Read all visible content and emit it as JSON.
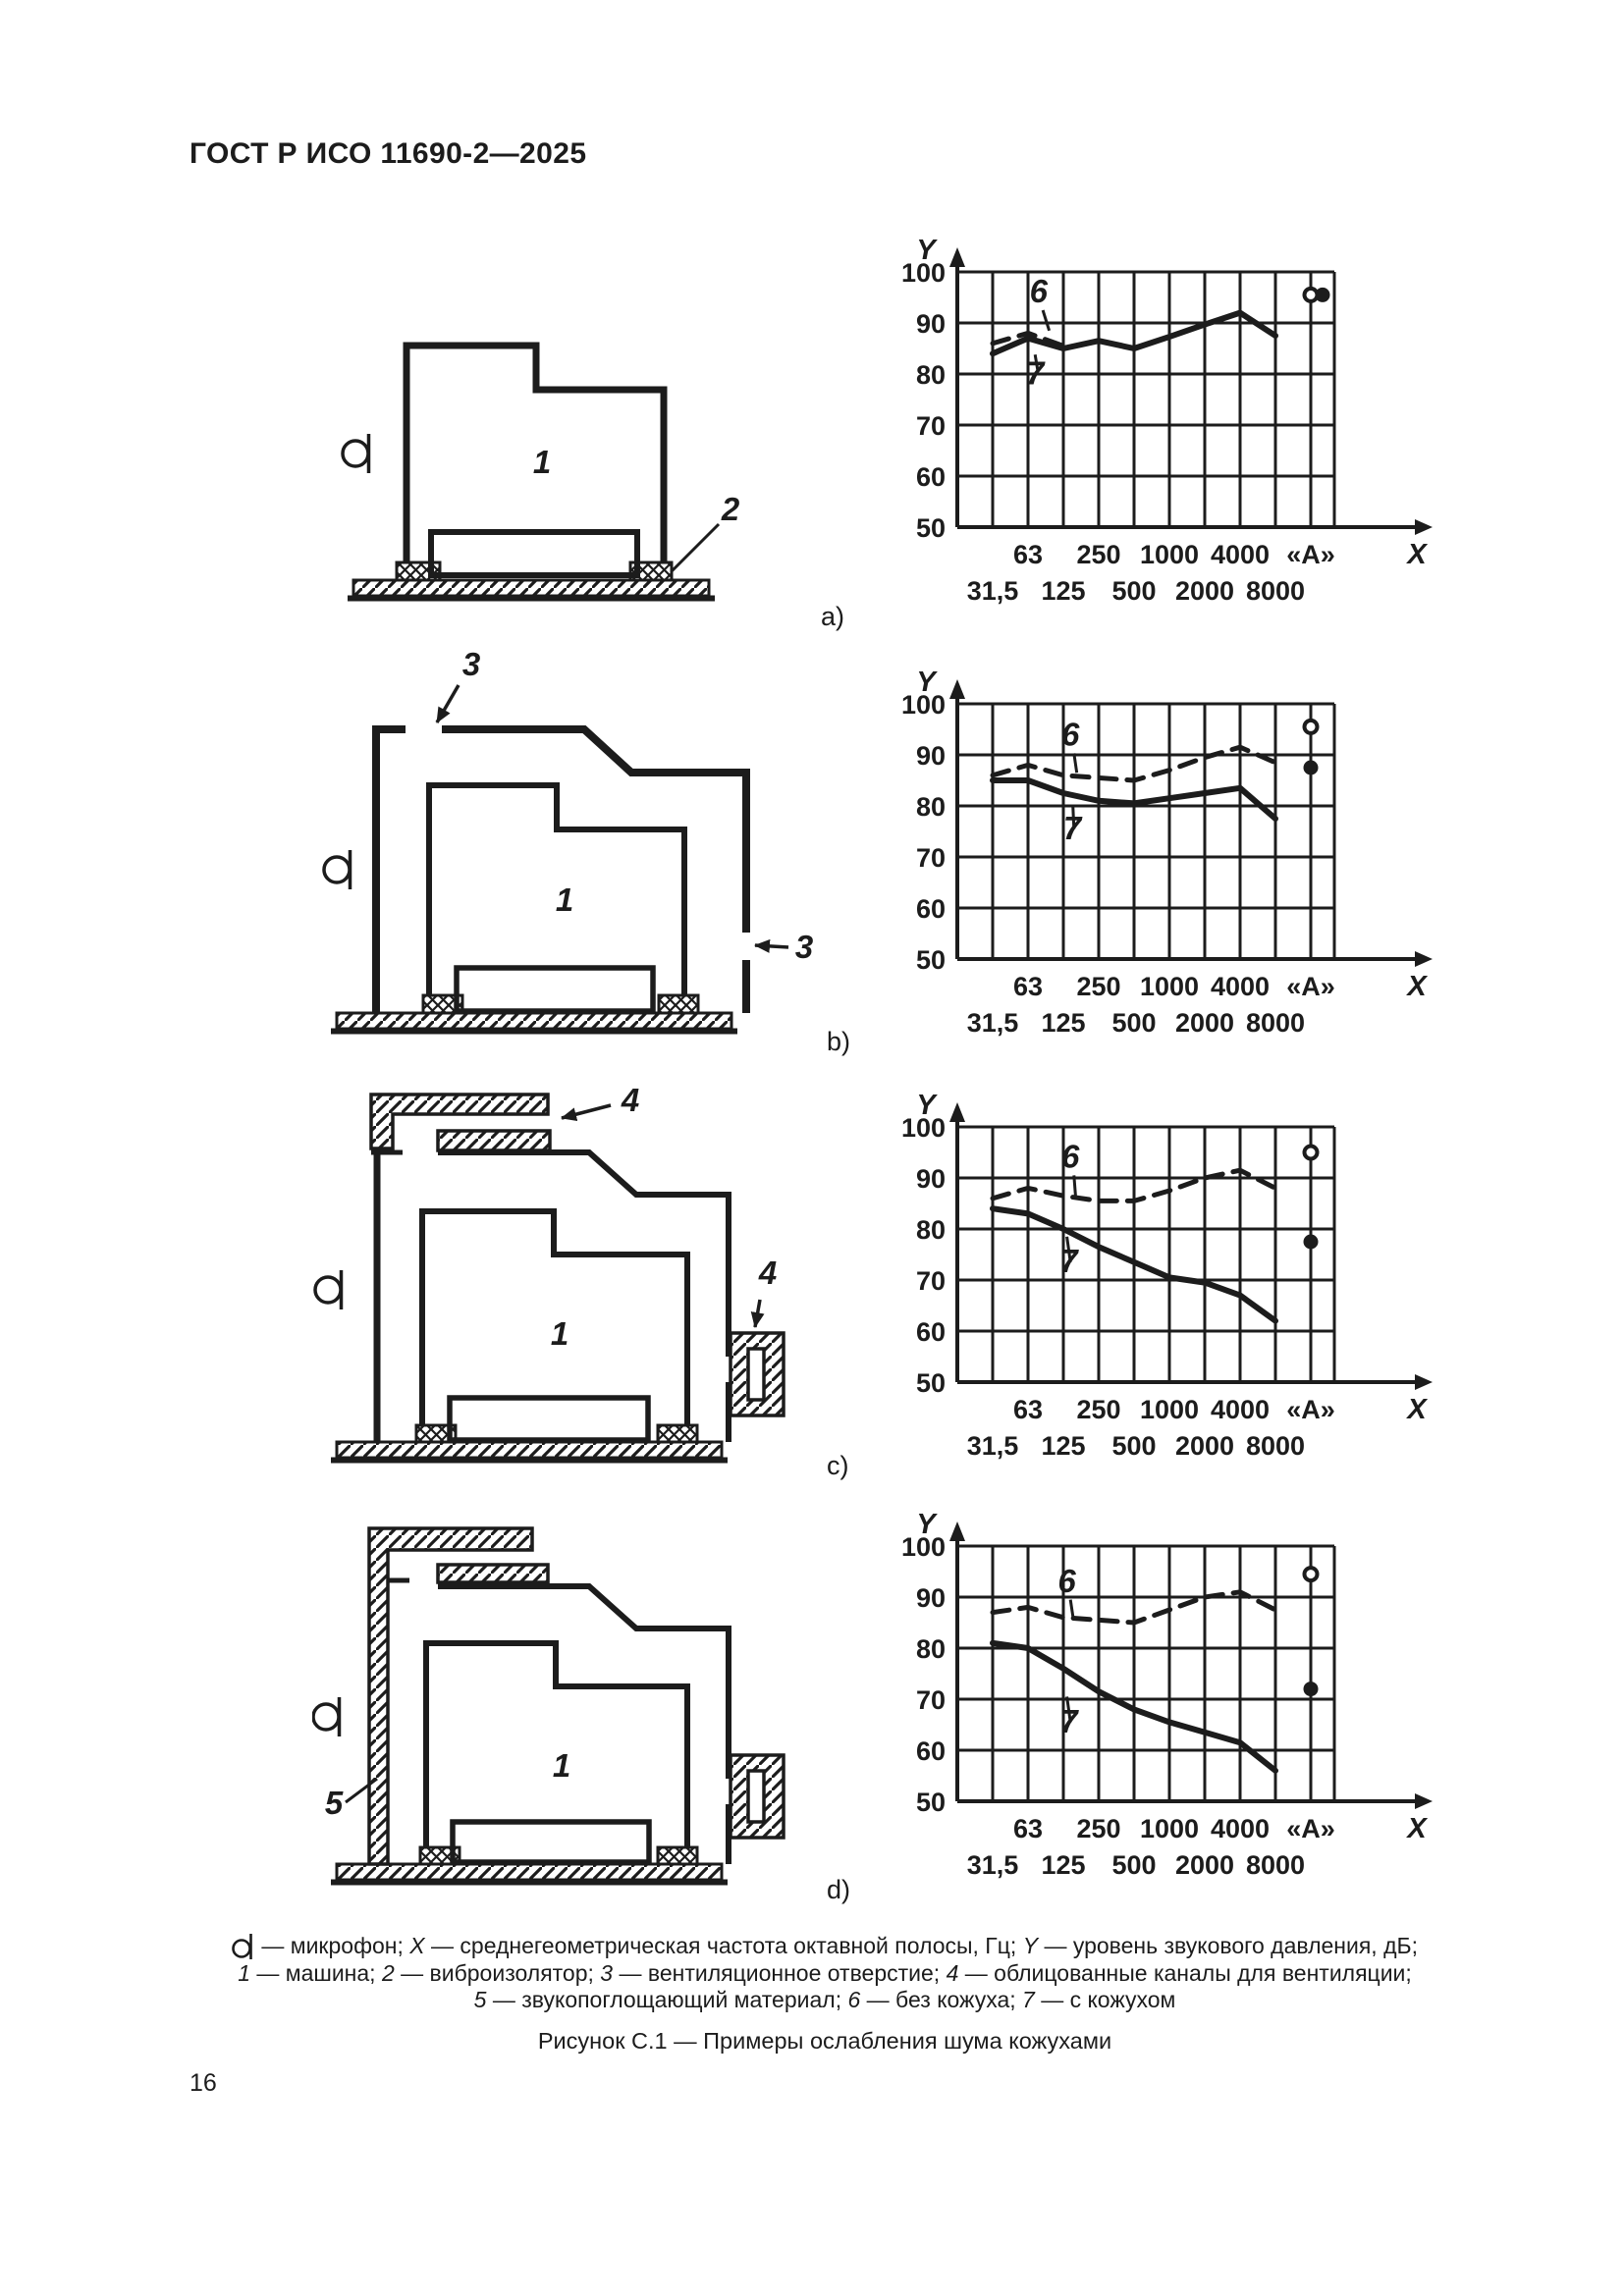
{
  "header": {
    "title": "ГОСТ Р ИСО 11690-2—2025"
  },
  "page_number": "16",
  "figure_caption": "Рисунок С.1 — Примеры ослабления шума кожухами",
  "row_labels": [
    "a)",
    "b)",
    "c)",
    "d)"
  ],
  "diagram_labels": {
    "machine": "1",
    "isolator": "2",
    "vent": "3",
    "duct": "4",
    "absorber": "5"
  },
  "caption_lines": [
    [
      {
        "sym": "mic"
      },
      {
        "t": " — микрофон; "
      },
      {
        "t": "X",
        "i": true
      },
      {
        "t": " — среднегеометрическая частота октавной полосы, Гц; "
      },
      {
        "t": "Y",
        "i": true
      },
      {
        "t": " — уровень звукового давления, дБ;"
      }
    ],
    [
      {
        "t": "1",
        "i": true
      },
      {
        "t": " — машина; "
      },
      {
        "t": "2",
        "i": true
      },
      {
        "t": " — виброизолятор; "
      },
      {
        "t": "3",
        "i": true
      },
      {
        "t": " — вентиляционное отверстие; "
      },
      {
        "t": "4",
        "i": true
      },
      {
        "t": " — облицованные каналы для вентиляции;"
      }
    ],
    [
      {
        "t": "5",
        "i": true
      },
      {
        "t": " — звукопоглощающий материал; "
      },
      {
        "t": "6",
        "i": true
      },
      {
        "t": " — без кожуха; "
      },
      {
        "t": "7",
        "i": true
      },
      {
        "t": " — с кожухом"
      }
    ]
  ],
  "chart_common": {
    "type": "line",
    "xlabel": "X",
    "ylabel": "Y",
    "ylim": [
      50,
      100
    ],
    "grid": true,
    "y_ticks": [
      100,
      90,
      80,
      70,
      60,
      50
    ],
    "x_categories": [
      "31,5",
      "63",
      "125",
      "250",
      "500",
      "1000",
      "2000",
      "4000",
      "8000",
      "«А»"
    ],
    "x_row1": [
      "63",
      "250",
      "1000",
      "4000",
      "«А»"
    ],
    "x_row2": [
      "31,5",
      "125",
      "500",
      "2000",
      "8000"
    ],
    "label6": "6",
    "label7": "7",
    "series6_name": "без кожуха",
    "series7_name": "с кожухом"
  },
  "chart_data": [
    {
      "id": "a",
      "type": "line",
      "series": [
        {
          "name": "6",
          "style": "dashed",
          "points": [
            [
              0,
              86
            ],
            [
              1,
              88
            ],
            [
              2,
              85.5
            ]
          ]
        },
        {
          "name": "7",
          "style": "solid",
          "points": [
            [
              0,
              84
            ],
            [
              1,
              87
            ],
            [
              2,
              85
            ],
            [
              3,
              86.5
            ],
            [
              4,
              85
            ],
            [
              5,
              87.3
            ],
            [
              6,
              89.7
            ],
            [
              7,
              92
            ],
            [
              8,
              87.5
            ]
          ]
        }
      ],
      "a_points": {
        "open": 95.5,
        "filled": 95.5,
        "filled_offset": true
      },
      "lbl6": {
        "x": 2.3,
        "y": 94
      },
      "ld6": [
        [
          2.42,
          92.5
        ],
        [
          2.6,
          88.5
        ]
      ],
      "lbl7": {
        "x": 2.2,
        "y": 78
      },
      "ld7": [
        [
          2.28,
          80.5
        ],
        [
          2.2,
          83.8
        ]
      ]
    },
    {
      "id": "b",
      "type": "line",
      "series": [
        {
          "name": "6",
          "style": "dashed",
          "points": [
            [
              0,
              86
            ],
            [
              1,
              88
            ],
            [
              2,
              86
            ],
            [
              3,
              85.5
            ],
            [
              4,
              85
            ],
            [
              5,
              87
            ],
            [
              6,
              89.5
            ],
            [
              7,
              91.5
            ],
            [
              8,
              88.5
            ]
          ]
        },
        {
          "name": "7",
          "style": "solid",
          "points": [
            [
              0,
              85
            ],
            [
              1,
              85
            ],
            [
              2,
              82.5
            ],
            [
              3,
              81
            ],
            [
              4,
              80.5
            ],
            [
              5,
              81.5
            ],
            [
              6,
              82.5
            ],
            [
              7,
              83.5
            ],
            [
              8,
              77.5
            ]
          ]
        }
      ],
      "a_points": {
        "open": 95.5,
        "filled": 87.5,
        "filled_offset": false
      },
      "lbl6": {
        "x": 3.2,
        "y": 91.8
      },
      "ld6": [
        [
          3.3,
          90.3
        ],
        [
          3.38,
          86.5
        ]
      ],
      "lbl7": {
        "x": 3.25,
        "y": 73.5
      },
      "ld7": [
        [
          3.3,
          75.5
        ],
        [
          3.27,
          80
        ]
      ]
    },
    {
      "id": "c",
      "type": "line",
      "series": [
        {
          "name": "6",
          "style": "dashed",
          "points": [
            [
              0,
              86
            ],
            [
              1,
              88
            ],
            [
              2,
              86.5
            ],
            [
              3,
              85.5
            ],
            [
              4,
              85.5
            ],
            [
              5,
              87.5
            ],
            [
              6,
              90
            ],
            [
              7,
              91.5
            ],
            [
              8,
              88
            ]
          ]
        },
        {
          "name": "7",
          "style": "solid",
          "points": [
            [
              0,
              84
            ],
            [
              1,
              83
            ],
            [
              2,
              80
            ],
            [
              3,
              76.5
            ],
            [
              4,
              73.5
            ],
            [
              5,
              70.5
            ],
            [
              6,
              69.5
            ],
            [
              7,
              67
            ],
            [
              8,
              62
            ]
          ]
        }
      ],
      "a_points": {
        "open": 95,
        "filled": 77.5,
        "filled_offset": false
      },
      "lbl6": {
        "x": 3.2,
        "y": 92
      },
      "ld6": [
        [
          3.3,
          90.5
        ],
        [
          3.35,
          86
        ]
      ],
      "lbl7": {
        "x": 3.15,
        "y": 71.5
      },
      "ld7": [
        [
          3.2,
          73.5
        ],
        [
          3.1,
          78.5
        ]
      ]
    },
    {
      "id": "d",
      "type": "line",
      "series": [
        {
          "name": "6",
          "style": "dashed",
          "points": [
            [
              0,
              87
            ],
            [
              1,
              88
            ],
            [
              2,
              86
            ],
            [
              3,
              85.5
            ],
            [
              4,
              85
            ],
            [
              5,
              87.5
            ],
            [
              6,
              90
            ],
            [
              7,
              91
            ],
            [
              8,
              87.5
            ]
          ]
        },
        {
          "name": "7",
          "style": "solid",
          "points": [
            [
              0,
              81
            ],
            [
              1,
              80
            ],
            [
              2,
              76
            ],
            [
              3,
              71.5
            ],
            [
              4,
              68
            ],
            [
              5,
              65.5
            ],
            [
              6,
              63.5
            ],
            [
              7,
              61.5
            ],
            [
              8,
              56
            ]
          ]
        }
      ],
      "a_points": {
        "open": 94.5,
        "filled": 72,
        "filled_offset": false
      },
      "lbl6": {
        "x": 3.1,
        "y": 91
      },
      "ld6": [
        [
          3.2,
          89.5
        ],
        [
          3.28,
          85.8
        ]
      ],
      "lbl7": {
        "x": 3.15,
        "y": 63.5
      },
      "ld7": [
        [
          3.2,
          65.5
        ],
        [
          3.1,
          70.5
        ]
      ]
    }
  ]
}
